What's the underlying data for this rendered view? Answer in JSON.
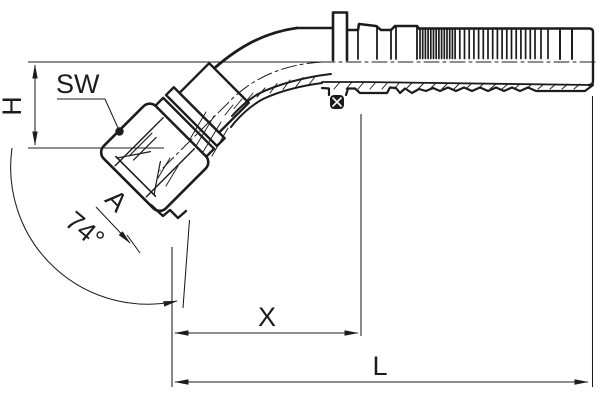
{
  "drawing": {
    "labels": {
      "sw": "SW",
      "h": "H",
      "a": "A",
      "angle": "74°",
      "x": "X",
      "l": "L"
    },
    "colors": {
      "line": "#1c1c1c",
      "background": "#ffffff"
    }
  }
}
